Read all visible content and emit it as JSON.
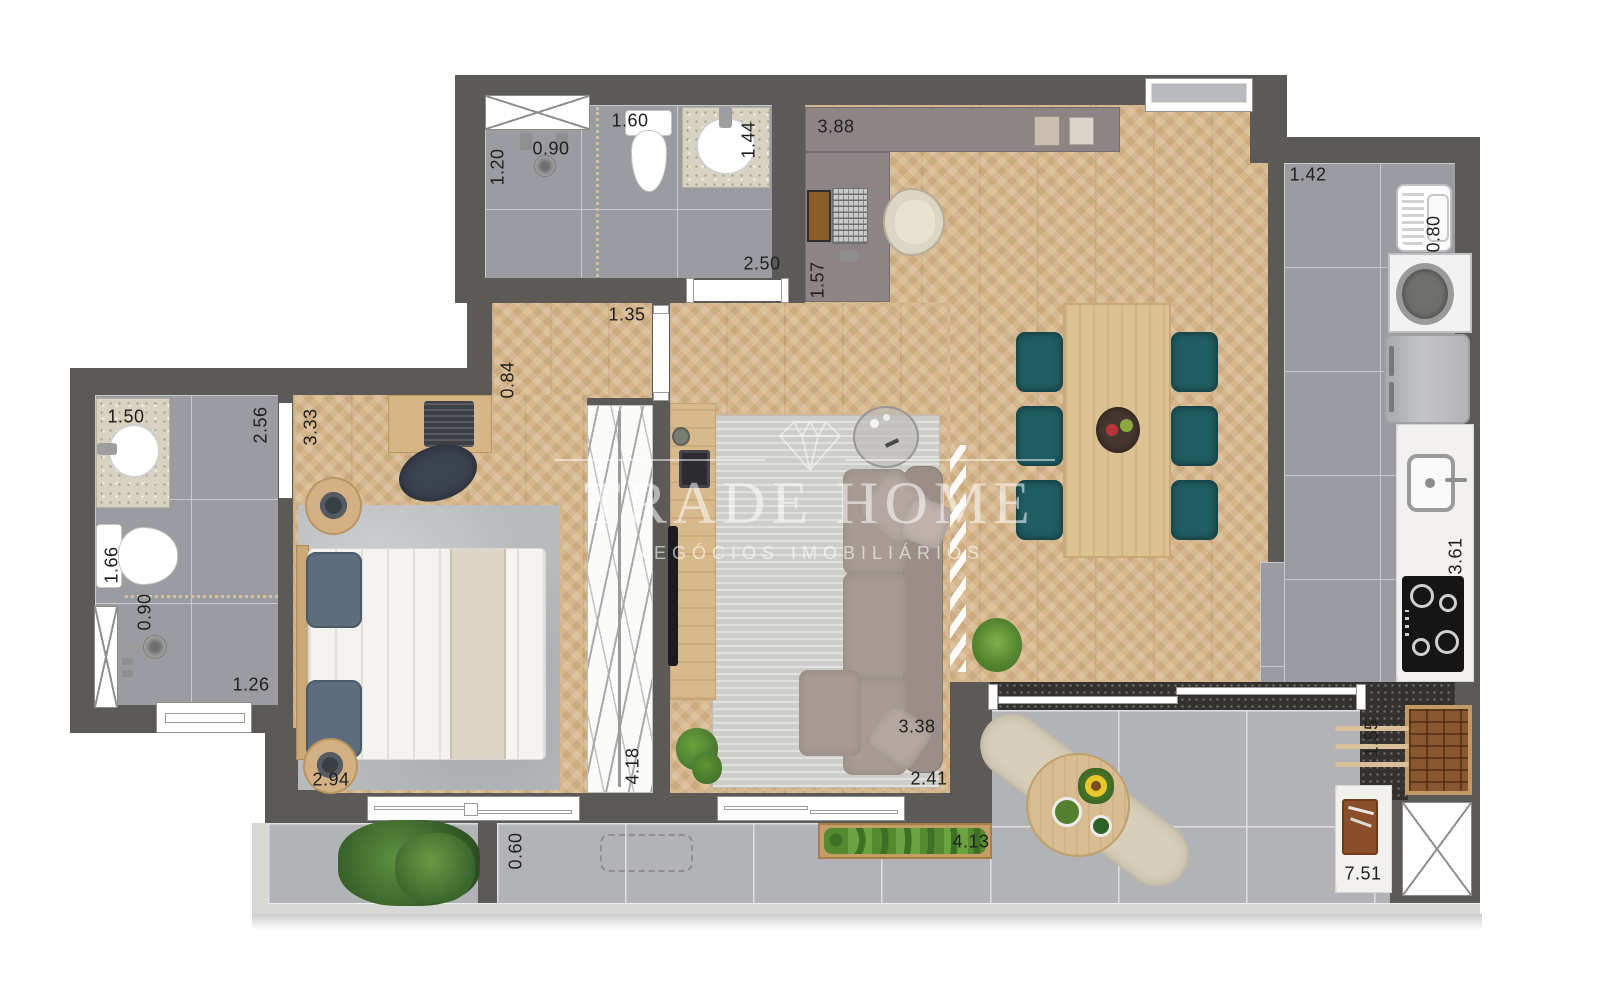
{
  "watermark": {
    "brand": "TRADE HOME",
    "tagline": "NEGÓCIOS IMOBILIÁRIOS"
  },
  "palette": {
    "wall": "#5b5a57",
    "wood_floor": "#d6b68a",
    "tile_floor": "#9b9ca1",
    "balcony_floor": "#b2b3b6",
    "chair_teal": "#205e63",
    "office_counter_taupe": "#8d8486",
    "furniture_wood": "#dcc193"
  },
  "dimensions": {
    "bath_social": {
      "shower_depth": "1.20",
      "shower_width": "0.90",
      "toilet_span": "1.60",
      "counter_span": "1.44",
      "room_width": "2.50"
    },
    "home_office": {
      "counter_width": "3.88",
      "nook_depth": "1.57"
    },
    "hall": {
      "door_span": "1.35",
      "passage_depth": "0.84"
    },
    "laundry": {
      "area_width": "1.42",
      "tank_span": "0.80"
    },
    "kitchen": {
      "counter_length": "3.61"
    },
    "bath_suite": {
      "counter_span": "1.50",
      "toilet_depth": "1.66",
      "shower_width": "0.90",
      "shower_span": "1.26",
      "room_length": "2.56"
    },
    "bedroom": {
      "room_length": "3.33",
      "room_width": "2.94",
      "closet_span": "4.18"
    },
    "living": {
      "room_width": "2.41"
    },
    "balcony": {
      "ledge_depth": "0.60",
      "planter_span": "4.13",
      "terrace_width": "3.38",
      "grill_depth": "1.55",
      "total_length": "7.51"
    }
  }
}
